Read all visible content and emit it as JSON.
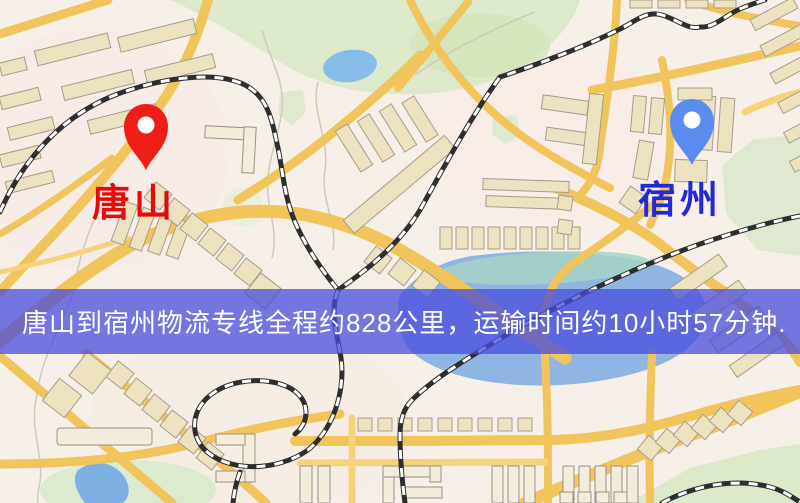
{
  "banner": {
    "text": "唐山到宿州物流专线全程约828公里，运输时间约10小时57分钟.",
    "background_color": "#484cdc",
    "text_color": "#ffffff"
  },
  "map": {
    "origin": {
      "label": "唐山",
      "pin_color": "#ee1d15",
      "label_color": "#e60a0a"
    },
    "destination": {
      "label": "宿州",
      "pin_color": "#5a8cf0",
      "label_color": "#2329d8"
    },
    "palette": {
      "road": "#f1c45c",
      "water": "#8fb6e2",
      "park": "#dcead0",
      "building": "#ece2c0",
      "railway": "#2e2e2e",
      "background": "#f7f0e8"
    }
  }
}
